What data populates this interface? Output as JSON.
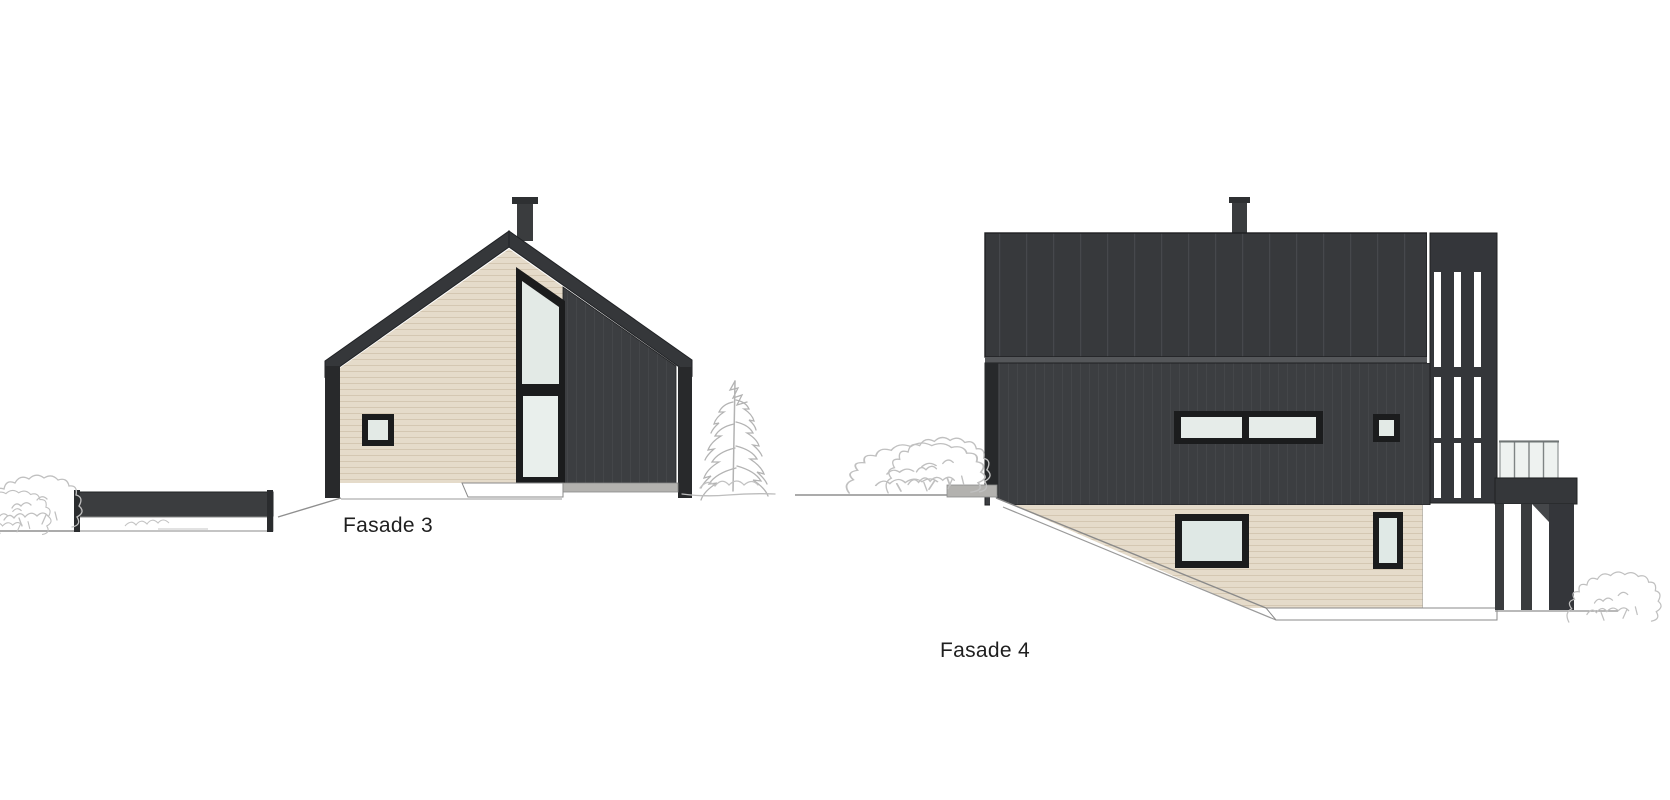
{
  "page": {
    "background": "#ffffff"
  },
  "drawing": {
    "elevations": [
      {
        "id": "fasade-3",
        "label": "Fasade 3"
      },
      {
        "id": "fasade-4",
        "label": "Fasade 4"
      }
    ],
    "colors": {
      "dark_cladding": "#3c3e41",
      "roof": "#37393c",
      "dark_trim": "#28292b",
      "window_frame": "#1b1c1d",
      "glass": "#e3eae6",
      "glass_bright": "#eef2f0",
      "wood_siding": "#e5dbca",
      "siding_line": "#d4c7b2",
      "concrete": "#b3b2af",
      "foundation": "#ffffff",
      "ground_line": "#8f8f8f",
      "vegetation": "#c0c0c0",
      "label_text": "#1f1f1f"
    }
  }
}
